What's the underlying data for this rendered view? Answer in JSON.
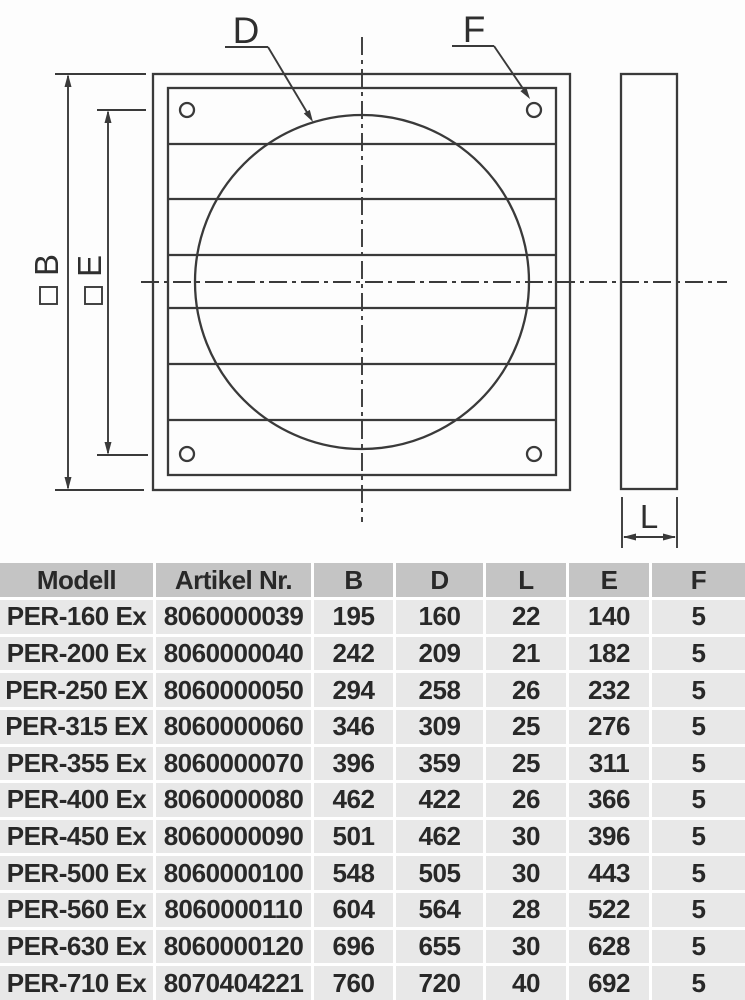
{
  "drawing": {
    "labels": {
      "d": "D",
      "f": "F",
      "b": "B",
      "e": "E",
      "l": "L"
    }
  },
  "table": {
    "headers": [
      "Modell",
      "Artikel Nr.",
      "B",
      "D",
      "L",
      "E",
      "F"
    ],
    "header_keys": [
      "modell",
      "artikel-nr",
      "b",
      "d",
      "l",
      "e",
      "f"
    ],
    "rows": [
      [
        "PER-160 Ex",
        "8060000039",
        "195",
        "160",
        "22",
        "140",
        "5"
      ],
      [
        "PER-200 Ex",
        "8060000040",
        "242",
        "209",
        "21",
        "182",
        "5"
      ],
      [
        "PER-250 EX",
        "8060000050",
        "294",
        "258",
        "26",
        "232",
        "5"
      ],
      [
        "PER-315 EX",
        "8060000060",
        "346",
        "309",
        "25",
        "276",
        "5"
      ],
      [
        "PER-355 Ex",
        "8060000070",
        "396",
        "359",
        "25",
        "311",
        "5"
      ],
      [
        "PER-400 Ex",
        "8060000080",
        "462",
        "422",
        "26",
        "366",
        "5"
      ],
      [
        "PER-450 Ex",
        "8060000090",
        "501",
        "462",
        "30",
        "396",
        "5"
      ],
      [
        "PER-500 Ex",
        "8060000100",
        "548",
        "505",
        "30",
        "443",
        "5"
      ],
      [
        "PER-560 Ex",
        "8060000110",
        "604",
        "564",
        "28",
        "522",
        "5"
      ],
      [
        "PER-630 Ex",
        "8060000120",
        "696",
        "655",
        "30",
        "628",
        "5"
      ],
      [
        "PER-710 Ex",
        "8070404221",
        "760",
        "720",
        "40",
        "692",
        "5"
      ]
    ]
  },
  "colors": {
    "header_bg": "#c4c4c4",
    "row_bg": "#e8e8e8",
    "line": "#3a3a3a",
    "text": "#282828"
  }
}
